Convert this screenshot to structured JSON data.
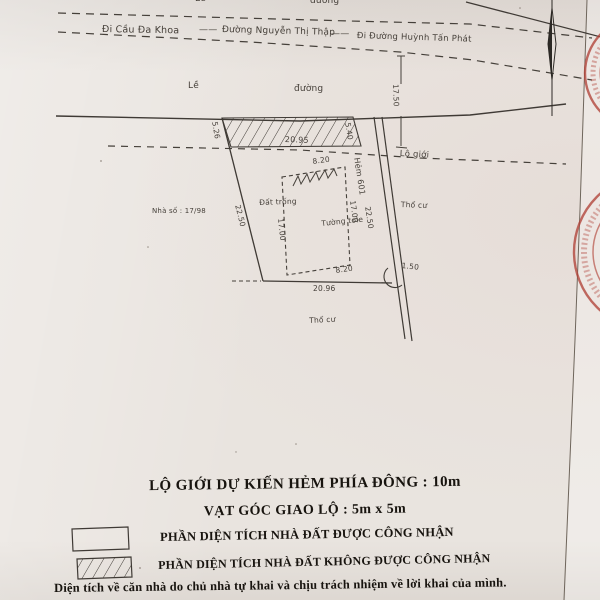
{
  "colors": {
    "paper": "#e9e4df",
    "ink": "#3f3a35",
    "heading_text": "#18140f",
    "stamp_red": "#b2463c"
  },
  "street_strip": {
    "sidewalk_top": "Lề",
    "road_top": "đường",
    "dir_left": "Đi Cầu Đa Khoa",
    "separator": "——",
    "street_name": "Đường Nguyễn Thị Thập",
    "dir_right": "Đi Đường Huỳnh Tấn Phát",
    "sidewalk": "Lề",
    "road": "đường",
    "road_width": "17.50",
    "boundary_label": "Lộ giới"
  },
  "parcel": {
    "house_number": "Nhà số : 17/98",
    "left_edge": "22.50",
    "bottom_edge": "20.96",
    "strip_width": "20.95",
    "strip_left": "5.26",
    "strip_right": "5.40",
    "empty_land": "Đất trống",
    "wall": "Tường tole",
    "house_width_top": "8.20",
    "house_width_bottom": "8.20",
    "house_depth_left": "17.00",
    "house_depth_right": "17.00",
    "alley": "Hẻm 601",
    "alley_length": "22.50",
    "corner_cut": "1.50",
    "land_right": "Thổ cư",
    "land_bottom": "Thổ cư"
  },
  "notes": {
    "line1": "LỘ GIỚI DỰ KIẾN HẺM  PHÍA ĐÔNG : 10m",
    "line2": "VẠT GÓC GIAO LỘ : 5m x 5m"
  },
  "legend": {
    "recognized": "PHẦN DIỆN TÍCH NHÀ ĐẤT ĐƯỢC CÔNG NHẬN",
    "not_recognized": "PHẦN DIỆN TÍCH NHÀ ĐẤT KHÔNG ĐƯỢC CÔNG NHẬN"
  },
  "footer": {
    "disclaimer": "Diện tích về căn nhà do chủ nhà tự khai và chịu trách nhiệm về lời khai của mình."
  }
}
